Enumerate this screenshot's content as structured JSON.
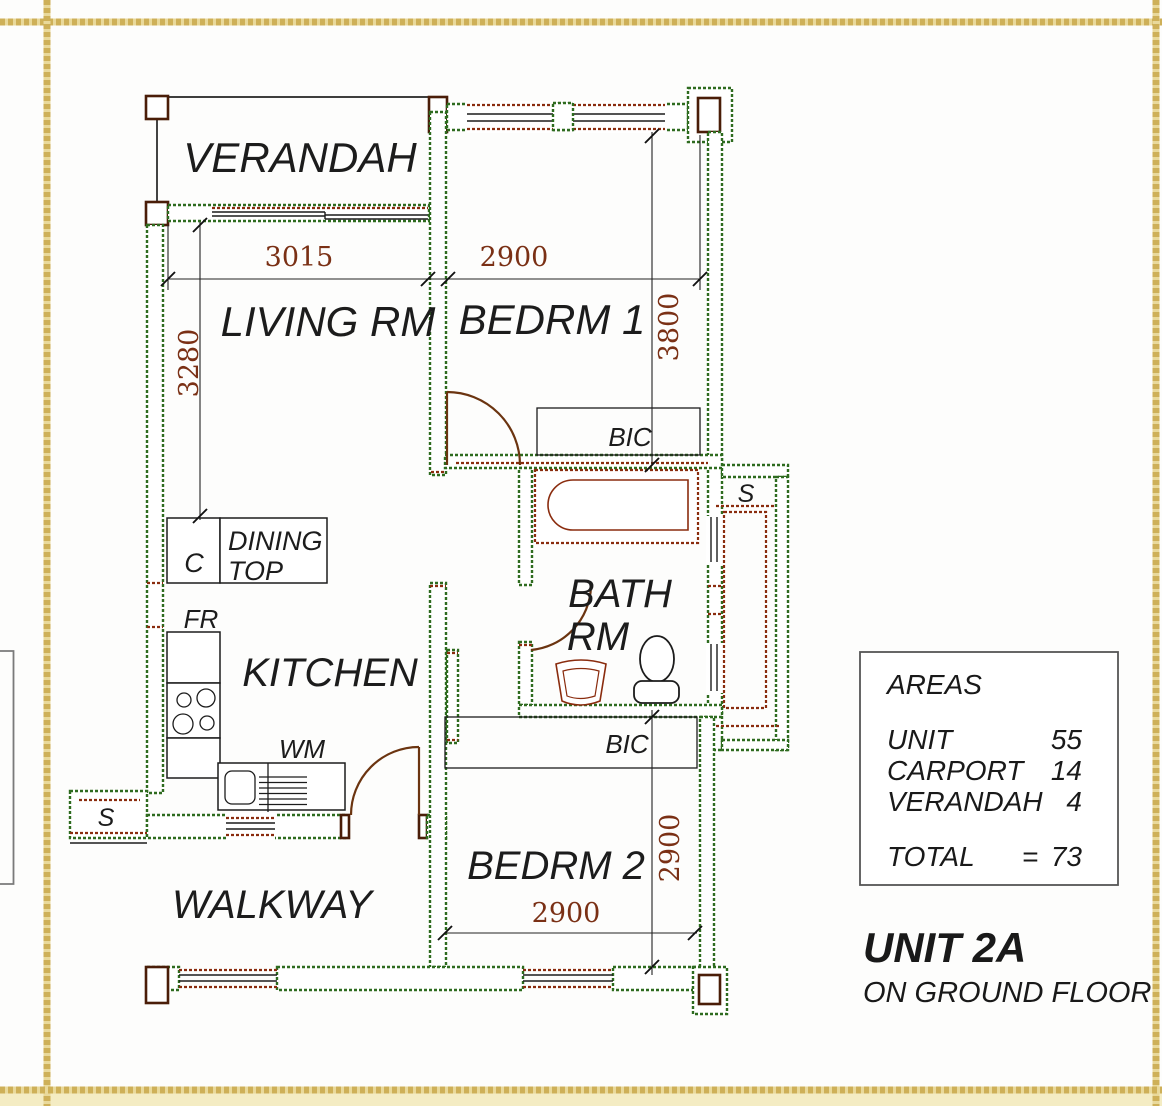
{
  "title_block": {
    "unit_title": "UNIT 2A",
    "floor_label": "ON GROUND FLOOR"
  },
  "areas": {
    "heading": "AREAS",
    "rows": [
      {
        "label": "UNIT",
        "value": "55"
      },
      {
        "label": "CARPORT",
        "value": "14"
      },
      {
        "label": "VERANDAH",
        "value": "4"
      }
    ],
    "total_label": "TOTAL",
    "equals_sign": "=",
    "total_value": "73"
  },
  "rooms": {
    "verandah": "VERANDAH",
    "living": "LIVING RM",
    "bedrm1": "BEDRM 1",
    "bath_line1": "BATH",
    "bath_line2": "RM",
    "kitchen": "KITCHEN",
    "bedrm2": "BEDRM 2",
    "walkway": "WALKWAY"
  },
  "fixtures": {
    "cupboard": "C",
    "dining_line1": "DINING",
    "dining_line2": "TOP",
    "fridge": "FR",
    "washing_machine": "WM",
    "store_left": "S",
    "store_shaft": "S",
    "bic_bedrm1": "BIC",
    "bic_bedrm2": "BIC"
  },
  "dimensions": {
    "living_width": "3015",
    "living_depth": "3280",
    "bedrm1_width": "2900",
    "bedrm1_depth": "3800",
    "bedrm2_width": "2900",
    "bedrm2_depth": "2900"
  },
  "colors": {
    "wall_green": "#2e6b1f",
    "wall_brown": "#8a2c0e",
    "door_brown": "#6b3410",
    "line_black": "#1c1c1c",
    "dim_text": "#7a3015",
    "frame_gold": "#c9a84c",
    "frame_gold_light": "#e9d99b",
    "frame_cream": "#f4ecc3"
  }
}
